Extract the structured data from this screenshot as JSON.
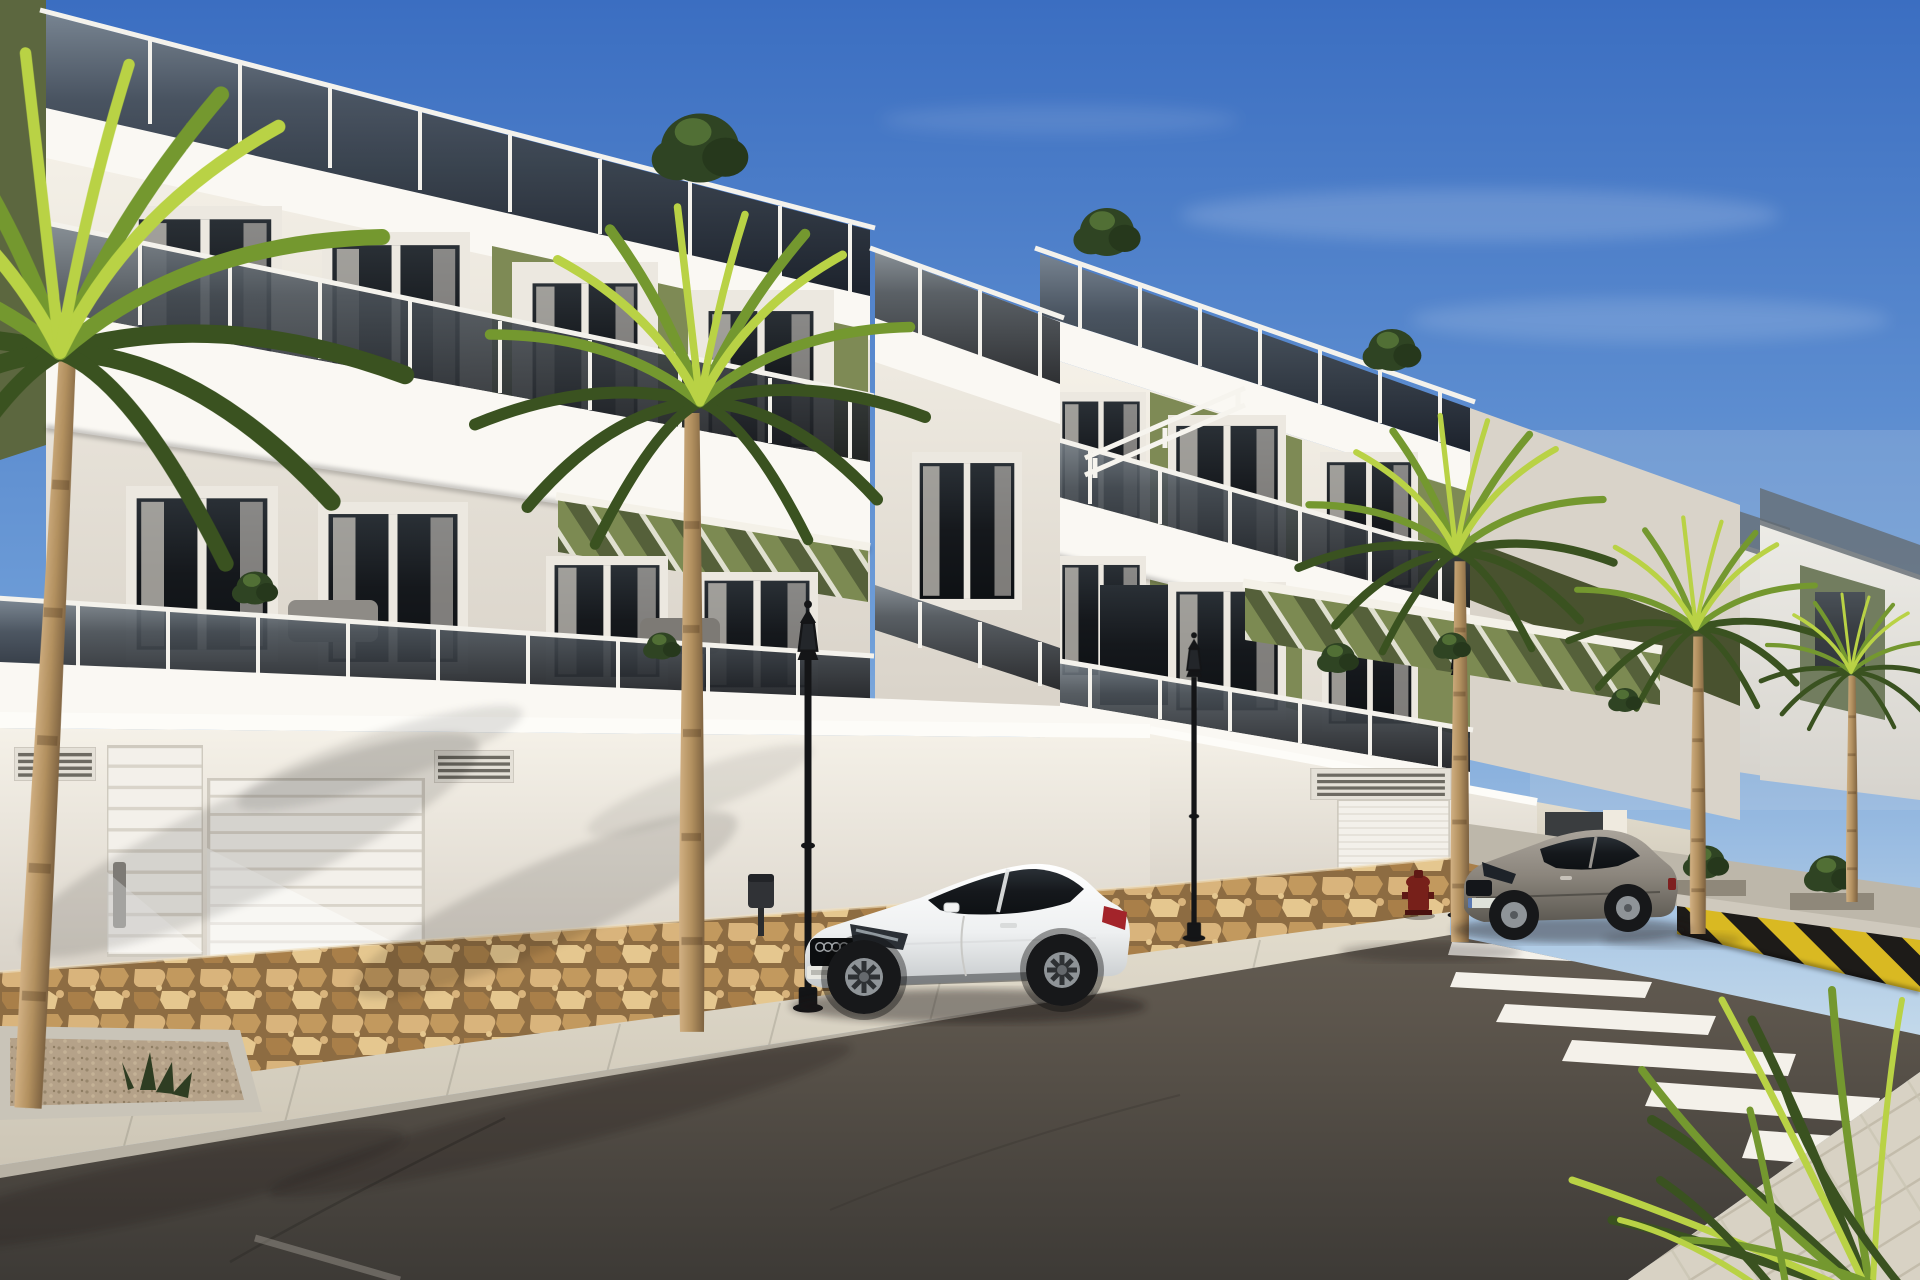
{
  "meta": {
    "title": "Sunny street view 3D render: new-build white apartment blocks with olive-green accents, palm trees, two parked coupes, crosswalk",
    "width_px": 1920,
    "height_px": 1280,
    "no_visible_text": true
  },
  "palette": {
    "sky-top": "#3b6ec1",
    "sky-mid": "#6f9ed8",
    "sky-horizon": "#c6dbeb",
    "haze": "#cfd9e2",
    "facade-sun": "#f5f1e8",
    "facade-cream": "#efe7da",
    "facade-shade": "#d9d3c9",
    "slab-white": "#faf8f3",
    "olive": "#7e8a55",
    "olive-shade": "#5c673f",
    "olive-deep": "#49522f",
    "pergola-green": "#7c8a52",
    "pergola-shade": "#55603a",
    "glass-smoke": "#4a5158",
    "glass-dark": "#17191d",
    "rail-post": "#f4f2ec",
    "window-frame": "#ece8e0",
    "curtain": "#c9c5be",
    "stone-a": "#d9b47c",
    "stone-b": "#c2995e",
    "stone-c": "#a97f49",
    "stone-d": "#e5c78f",
    "mortar": "#8d6c42",
    "sidewalk-a": "#e2dccd",
    "sidewalk-b": "#cdc6b6",
    "curb": "#b8b2a5",
    "asphalt-far": "#5c554c",
    "asphalt-near": "#3d3a36",
    "stripe-white": "#f4f1ea",
    "barrier-yellow": "#d9b922",
    "barrier-black": "#1d1b18",
    "lamp-black": "#141517",
    "hydrant-red": "#77201a",
    "car-white-a": "#ffffff",
    "car-white-b": "#eef0f1",
    "car-white-c": "#c4c8ca",
    "car-gray-a": "#aaa49b",
    "car-gray-b": "#8b857c",
    "car-gray-c": "#5d5952",
    "car-glass": "#181c22",
    "wheel-tire": "#17181a",
    "wheel-rim": "#8f9498",
    "trunk-a": "#d2b184",
    "trunk-b": "#b2905f",
    "trunk-c": "#7c6140",
    "frond-light": "#b9d245",
    "frond-mid": "#74982f",
    "frond-dark": "#3a5220",
    "tree-dark": "#2f4423",
    "tree-lite": "#5a7a3a",
    "shadow-ink": "#1c1915"
  },
  "scene": {
    "setting": "daytime, clear blue sky, low sun from the left casting palm shadows on white rendered walls",
    "counts": {
      "apartment_blocks": 3,
      "palm_trees": 5,
      "foreground_palm_fronds_clusters": 1,
      "street_lamps": 3,
      "parked_cars": 2,
      "garage_doors": 2,
      "pedestrian_doors": 1,
      "wall_vents": 3,
      "crosswalk_stripes": 7,
      "rooftop_trees": 3,
      "balcony_plants": 5,
      "fire_hydrants": 1,
      "litter_bins": 1,
      "planters": 3
    },
    "objects": [
      {
        "name": "left-apartment-block",
        "description": "three-storey white block, olive-green feature panels, smoked-glass balcony balustrades, roof terrace with glass railing",
        "approx_position": "0,0 to 1070,720"
      },
      {
        "name": "right-apartment-block",
        "description": "matching stepped block further up the street with green pergola over ground terraces",
        "approx_position": "1030,230 to 1740,860"
      },
      {
        "name": "far-buildings",
        "description": "additional identical units receding to the right behind palms",
        "approx_position": "1530,430 to 1920,800"
      },
      {
        "name": "roof-terrace-railings",
        "description": "smoked glass panels with white posts along all rooflines",
        "approx_position": "top of each block"
      },
      {
        "name": "green-pergolas",
        "description": "olive louvred pergolas over ground-floor terraces",
        "approx_position": "555,495 and 1245,585"
      },
      {
        "name": "street-wall",
        "description": "white boundary/garage wall with moulded cornice and louvre vents",
        "approx_position": "0,710 to 1540,905"
      },
      {
        "name": "stone-base",
        "description": "rustic tan stone cladding strip at wall base",
        "approx_position": "0,970 to 1540,915"
      },
      {
        "name": "garage-door-left",
        "description": "white sectional garage door",
        "approx_position": "207,778"
      },
      {
        "name": "pedestrian-door",
        "description": "white slatted pedestrian door with grey pull",
        "approx_position": "107,745"
      },
      {
        "name": "garage-door-right",
        "description": "smaller white garage door up the hill",
        "approx_position": "1337,800"
      },
      {
        "name": "white-coupe-car",
        "description": "white two-door coupe (Audi-TT style) parked facing left",
        "approx_position": "800,862 to 1135,1010"
      },
      {
        "name": "gray-coupe-car",
        "description": "grey/beige two-door coupe (Megane style) parked near crosswalk",
        "approx_position": "1462,826 to 1678,940"
      },
      {
        "name": "crosswalk",
        "description": "white zebra stripes crossing the dark asphalt",
        "approx_position": "1450,940 to 1920,1170"
      },
      {
        "name": "striped-barrier",
        "description": "low yellow-and-black diagonally striped kerb wall",
        "approx_position": "1677,895 to 1920,990"
      },
      {
        "name": "street-lamps",
        "description": "three classic black lantern street lamps",
        "approx_position": "808,1008 / 1194,938 / 1458,915"
      },
      {
        "name": "fire-hydrant",
        "description": "small dark-red hydrant on upper sidewalk",
        "approx_position": "1406,880"
      },
      {
        "name": "litter-bin",
        "description": "dark pole-mounted litter bin",
        "approx_position": "748,874"
      },
      {
        "name": "main-palm",
        "description": "tall palm in front of the facade",
        "approx_position": "trunk base 692,1032"
      },
      {
        "name": "left-palm",
        "description": "large palm at left edge, fronds over top-left corner",
        "approx_position": "base 28,1108"
      },
      {
        "name": "right-palms",
        "description": "row of three palms receding along the street",
        "approx_position": "1460,942 / 1698,934 / 1852,902"
      },
      {
        "name": "foreground-fronds",
        "description": "spiky yucca/palmetto fronds entering bottom-right corner",
        "approx_position": "1700,990 to 1920,1280"
      },
      {
        "name": "sidewalk",
        "description": "pale paved sidewalk with kerb running along wall base",
        "approx_position": "0,1105 to 1450,915"
      },
      {
        "name": "corner-pavement",
        "description": "light block-paved pavement wedge at bottom right",
        "approx_position": "1630,1280 to 1920,1072"
      },
      {
        "name": "road",
        "description": "dark asphalt street with faint crack and edge line",
        "approx_position": "lower half"
      },
      {
        "name": "gravel-planter",
        "description": "kerbed gravel planter bed with small agaves",
        "approx_position": "0,1026 to 240,1112"
      }
    ]
  }
}
